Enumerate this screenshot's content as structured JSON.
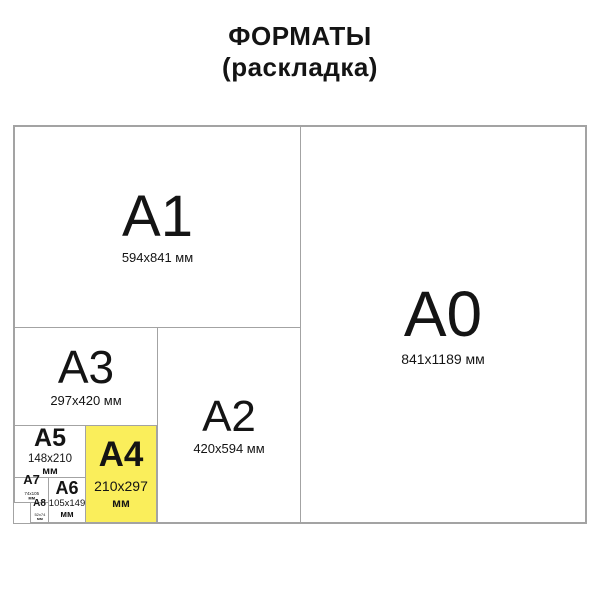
{
  "title": {
    "line1": "ФОРМАТЫ",
    "line2": "(раскладка)"
  },
  "colors": {
    "highlight": "#faee5b",
    "line": "#a3a3a3",
    "text": "#141414",
    "background": "#ffffff"
  },
  "formats": {
    "a0": {
      "label": "A0",
      "dims": "841x1189 мм"
    },
    "a1": {
      "label": "A1",
      "dims": "594x841 мм"
    },
    "a2": {
      "label": "A2",
      "dims": "420x594 мм"
    },
    "a3": {
      "label": "A3",
      "dims": "297x420 мм"
    },
    "a4": {
      "label": "A4",
      "size": "210x297",
      "unit": "мм"
    },
    "a5": {
      "label": "A5",
      "size": "148x210",
      "unit": "мм"
    },
    "a6": {
      "label": "A6",
      "size": "105x149",
      "unit": "мм"
    },
    "a7": {
      "label": "A7",
      "size": "74x105",
      "unit": "мм"
    },
    "a8": {
      "label": "A8",
      "size": "52x74",
      "unit": "мм"
    }
  }
}
